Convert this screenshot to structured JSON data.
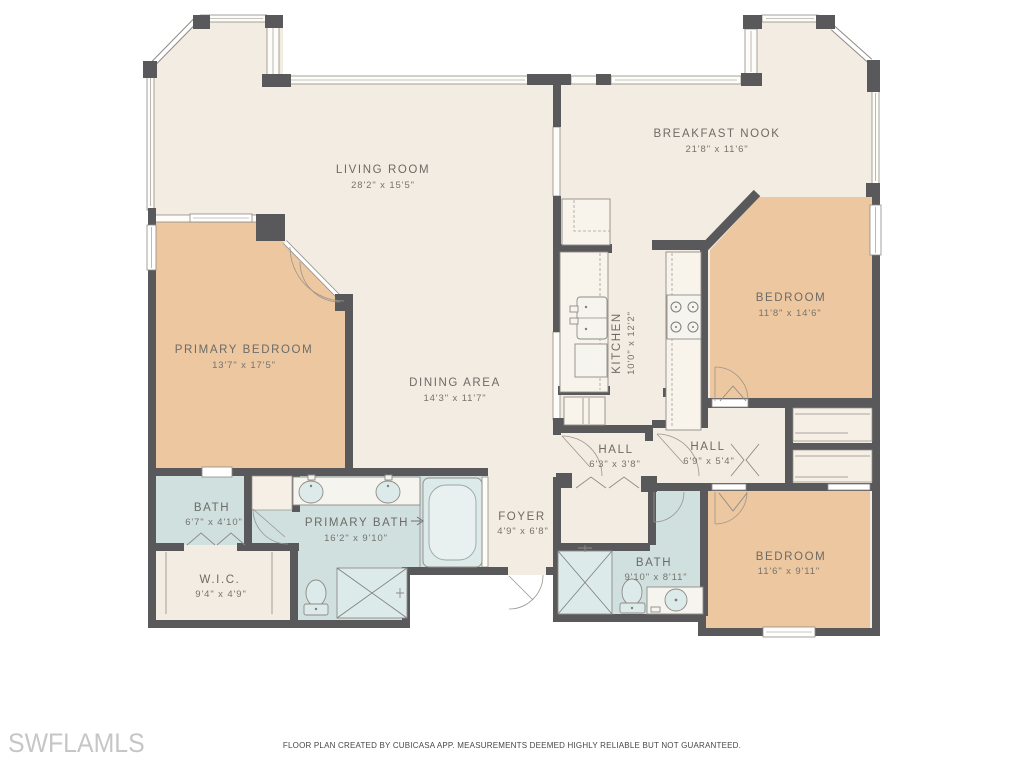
{
  "title": "Residential floor plan",
  "rooms": {
    "living": {
      "name": "LIVING ROOM",
      "dims": "28'2\" x 15'5\""
    },
    "nook": {
      "name": "BREAKFAST NOOK",
      "dims": "21'8\" x 11'6\""
    },
    "primary_bedroom": {
      "name": "PRIMARY BEDROOM",
      "dims": "13'7\" x 17'5\""
    },
    "dining": {
      "name": "DINING AREA",
      "dims": "14'3\" x 11'7\""
    },
    "kitchen": {
      "name": "KITCHEN",
      "dims": "10'0\" x 12'2\""
    },
    "bedroom_ne": {
      "name": "BEDROOM",
      "dims": "11'8\" x 14'6\""
    },
    "hall_a": {
      "name": "HALL",
      "dims": "6'3\" x 3'8\""
    },
    "hall_b": {
      "name": "HALL",
      "dims": "6'9\" x 5'4\""
    },
    "bath_a": {
      "name": "BATH",
      "dims": "6'7\" x 4'10\""
    },
    "primary_bath": {
      "name": "PRIMARY BATH",
      "dims": "16'2\" x 9'10\""
    },
    "foyer": {
      "name": "FOYER",
      "dims": "4'9\" x 6'8\""
    },
    "wic": {
      "name": "W.I.C.",
      "dims": "9'4\" x 4'9\""
    },
    "bath_b": {
      "name": "BATH",
      "dims": "9'10\" x 8'11\""
    },
    "bedroom_se": {
      "name": "BEDROOM",
      "dims": "11'6\" x 9'11\""
    }
  },
  "footer": {
    "watermark": "SWFLAMLS",
    "disclaimer": "FLOOR PLAN CREATED BY CUBICASA APP. MEASUREMENTS DEEMED HIGHLY RELIABLE BUT NOT GUARANTEED."
  },
  "palette": {
    "floor": "#f3ece2",
    "bedroom_fill": "#ecc7a0",
    "bath_fill": "#cfe0de",
    "wall": "#59595b",
    "line": "#8f8b85",
    "label_text": "#6d6b66",
    "dims_text": "#76736d",
    "watermark_text": "#c6c6c6"
  }
}
